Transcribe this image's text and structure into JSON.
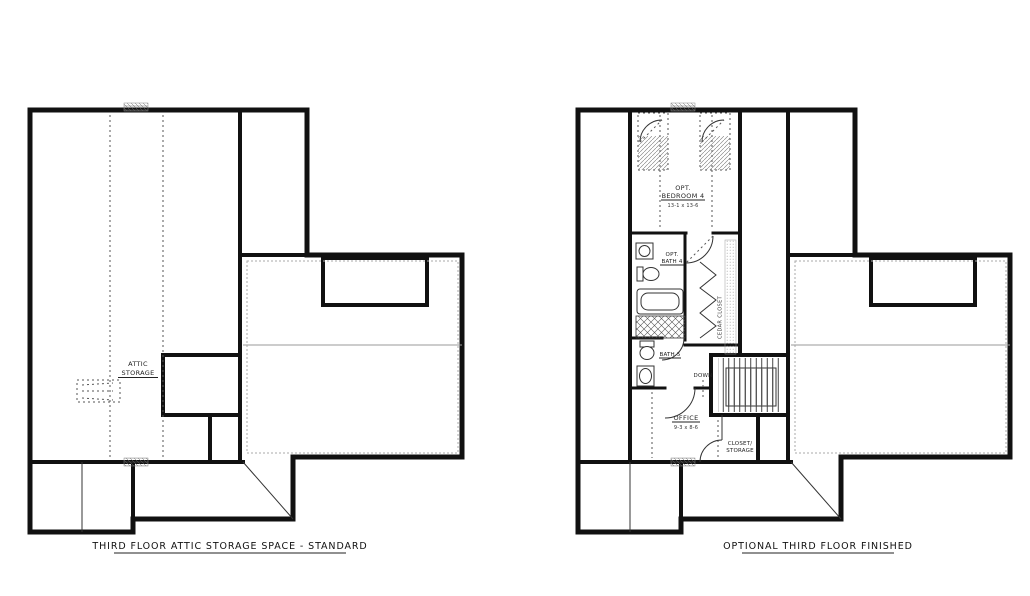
{
  "document": {
    "type": "floor-plan-sheet",
    "background": "#ffffff"
  },
  "colors": {
    "wall": "#111111",
    "thin_line": "#333333",
    "gray_line": "#9a9a9a",
    "dashed_line": "#555555",
    "text": "#222222"
  },
  "plans": {
    "left": {
      "caption": "THIRD FLOOR ATTIC STORAGE SPACE - STANDARD",
      "rooms": {
        "attic_storage": {
          "line1": "ATTIC",
          "line2": "STORAGE"
        }
      }
    },
    "right": {
      "caption": "OPTIONAL THIRD FLOOR FINISHED",
      "rooms": {
        "bedroom4": {
          "line1": "OPT.",
          "line2": "BEDROOM 4",
          "dims": "13-1 x 13-6"
        },
        "bath4": {
          "line1": "OPT.",
          "line2": "BATH 4"
        },
        "bath5": {
          "label": "BATH 5"
        },
        "cedar_closet": {
          "label": "CEDAR CLOSET"
        },
        "stairs": {
          "label": "DOWN"
        },
        "office": {
          "label": "OFFICE",
          "dims": "9-3 x 8-6"
        },
        "closet_storage": {
          "line1": "CLOSET/",
          "line2": "STORAGE"
        }
      }
    }
  }
}
